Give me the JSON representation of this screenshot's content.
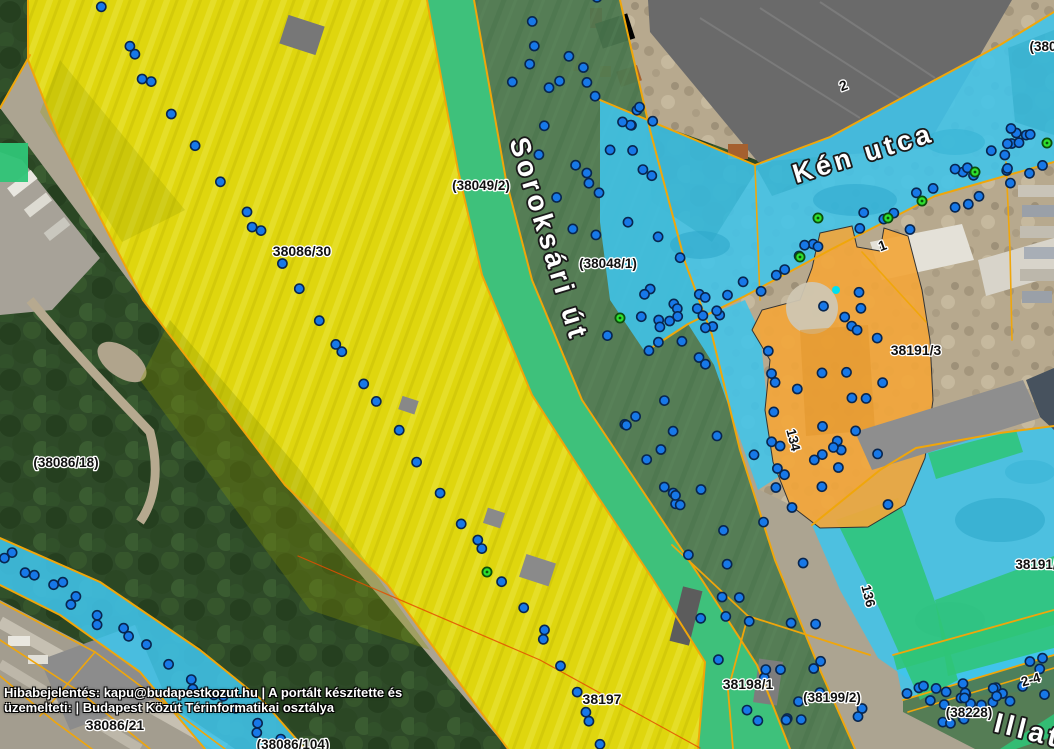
{
  "app": {
    "name": "Budapest Közút térinformatikai térkép",
    "view": "aerial-cadastre"
  },
  "footer": {
    "line1": "Hibabejelentés: kapu@budapestkozut.hu | A portált készítette és",
    "line2": "üzemelteti: | Budapest Közút Térinformatikai osztálya"
  },
  "streets": [
    {
      "name": "Soroksári út",
      "x": 540,
      "y": 242,
      "rotation": 73,
      "size": 28
    },
    {
      "name": "Kén utca",
      "x": 866,
      "y": 162,
      "rotation": -17,
      "size": 27
    },
    {
      "name": "Illato",
      "x": 1036,
      "y": 742,
      "rotation": 14,
      "size": 28
    }
  ],
  "parcel_labels": [
    {
      "text": "38086/30",
      "x": 302,
      "y": 256,
      "rotation": 0,
      "size": 14
    },
    {
      "text": "(38049/2)",
      "x": 481,
      "y": 190,
      "rotation": 0,
      "size": 13.5
    },
    {
      "text": "(38048/1)",
      "x": 608,
      "y": 268,
      "rotation": 0,
      "size": 13.5
    },
    {
      "text": "(38086/18)",
      "x": 66,
      "y": 467,
      "rotation": 0,
      "size": 13.5
    },
    {
      "text": "38191/3",
      "x": 916,
      "y": 355,
      "rotation": 0,
      "size": 14
    },
    {
      "text": "38197",
      "x": 602,
      "y": 704,
      "rotation": 0,
      "size": 14
    },
    {
      "text": "38198/1",
      "x": 748,
      "y": 689,
      "rotation": 0,
      "size": 14
    },
    {
      "text": "(38199/2)",
      "x": 832,
      "y": 702,
      "rotation": 0,
      "size": 13.5
    },
    {
      "text": "38086/21",
      "x": 115,
      "y": 730,
      "rotation": 0,
      "size": 14
    },
    {
      "text": "(38086/104)",
      "x": 293,
      "y": 749,
      "rotation": 0,
      "size": 13.5
    },
    {
      "text": "(38228)",
      "x": 969,
      "y": 717,
      "rotation": 0,
      "size": 13.5
    },
    {
      "text": "38191/",
      "x": 1036,
      "y": 569,
      "rotation": 0,
      "size": 13.5
    },
    {
      "text": "(380",
      "x": 1043,
      "y": 51,
      "rotation": 0,
      "size": 13.5
    },
    {
      "text": "2",
      "x": 845,
      "y": 90,
      "rotation": -20,
      "size": 14
    },
    {
      "text": "1",
      "x": 884,
      "y": 250,
      "rotation": -20,
      "size": 14
    },
    {
      "text": "134",
      "x": 789,
      "y": 441,
      "rotation": 76,
      "size": 13.5
    },
    {
      "text": "136",
      "x": 864,
      "y": 597,
      "rotation": 76,
      "size": 13.5
    },
    {
      "text": "2-4",
      "x": 1032,
      "y": 684,
      "rotation": -16,
      "size": 13.5
    }
  ],
  "colors": {
    "overlay_yellow": "#e4dc00",
    "overlay_green_road": "#4d7950",
    "overlay_teal": "#2fc577",
    "overlay_cyan": "#40c4ea",
    "overlay_orange": "#f2a63b",
    "boundary_line": "#f0a60a",
    "boundary_line_red": "#e44d00",
    "marker_blue": "#1778e8",
    "marker_blue_stroke": "#08264f",
    "marker_green": "#2ee02e",
    "marker_green_stroke": "#0b4f0b",
    "marker_aqua": "#00e0f0",
    "label_text": "#111111",
    "label_halo": "#ffffff",
    "street_text": "#ffffff",
    "footer_text": "#ffffff"
  },
  "marker_chains": [
    {
      "name": "parcel-38086-boundary-markers",
      "type": "points",
      "pair_chance": 0.3,
      "jitter": 2,
      "points": [
        [
          103,
          6
        ],
        [
          128,
          48
        ],
        [
          150,
          82
        ],
        [
          172,
          112
        ],
        [
          196,
          146
        ],
        [
          222,
          180
        ],
        [
          247,
          210
        ],
        [
          262,
          230
        ],
        [
          282,
          262
        ],
        [
          300,
          290
        ],
        [
          320,
          320
        ],
        [
          342,
          352
        ],
        [
          362,
          382
        ],
        [
          378,
          403
        ],
        [
          398,
          432
        ],
        [
          418,
          462
        ],
        [
          440,
          494
        ],
        [
          462,
          524
        ],
        [
          482,
          550
        ],
        [
          503,
          580
        ],
        [
          523,
          608
        ],
        [
          543,
          638
        ],
        [
          560,
          664
        ],
        [
          577,
          694
        ],
        [
          590,
          722
        ],
        [
          598,
          745
        ]
      ]
    },
    {
      "name": "soroksari-ut-markers",
      "type": "band",
      "count": 92,
      "halfwidth": 64,
      "line": [
        [
          548,
          -8
        ],
        [
          598,
          140
        ],
        [
          636,
          270
        ],
        [
          676,
          395
        ],
        [
          718,
          505
        ],
        [
          758,
          600
        ],
        [
          798,
          685
        ],
        [
          828,
          755
        ]
      ]
    },
    {
      "name": "ken-utca-markers",
      "type": "band",
      "count": 36,
      "halfwidth": 20,
      "line": [
        [
          640,
          336
        ],
        [
          700,
          306
        ],
        [
          760,
          280
        ],
        [
          820,
          252
        ],
        [
          880,
          224
        ],
        [
          940,
          196
        ],
        [
          1000,
          170
        ],
        [
          1050,
          146
        ]
      ]
    },
    {
      "name": "ken-utca-markers-upper",
      "type": "band",
      "count": 10,
      "halfwidth": 13,
      "line": [
        [
          950,
          160
        ],
        [
          1054,
          126
        ]
      ]
    },
    {
      "name": "orange-parcel-markers",
      "type": "band",
      "count": 24,
      "halfwidth": 50,
      "line": [
        [
          815,
          300
        ],
        [
          845,
          380
        ],
        [
          855,
          465
        ],
        [
          850,
          515
        ]
      ]
    },
    {
      "name": "orange-left-edge-markers",
      "type": "points",
      "pair_chance": 0.4,
      "jitter": 2,
      "points": [
        [
          770,
          352
        ],
        [
          776,
          382
        ],
        [
          773,
          412
        ],
        [
          781,
          444
        ],
        [
          784,
          476
        ],
        [
          791,
          506
        ]
      ]
    },
    {
      "name": "sw-cyan-band-markers",
      "type": "points",
      "pair_chance": 0.55,
      "jitter": 3,
      "points": [
        [
          6,
          558
        ],
        [
          28,
          570
        ],
        [
          52,
          584
        ],
        [
          76,
          598
        ],
        [
          100,
          614
        ],
        [
          124,
          630
        ],
        [
          148,
          646
        ],
        [
          170,
          662
        ],
        [
          192,
          678
        ],
        [
          214,
          694
        ],
        [
          236,
          710
        ],
        [
          258,
          726
        ],
        [
          280,
          742
        ],
        [
          298,
          750
        ]
      ]
    },
    {
      "name": "illatos-ut-markers",
      "type": "band",
      "count": 30,
      "halfwidth": 22,
      "line": [
        [
          895,
          716
        ],
        [
          960,
          698
        ],
        [
          1020,
          682
        ],
        [
          1058,
          672
        ]
      ]
    }
  ],
  "green_markers": [
    [
      818,
      218
    ],
    [
      888,
      218
    ],
    [
      922,
      201
    ],
    [
      975,
      172
    ],
    [
      1047,
      143
    ],
    [
      800,
      257
    ],
    [
      620,
      318
    ],
    [
      487,
      572
    ]
  ],
  "aqua_marker": [
    836,
    290
  ]
}
